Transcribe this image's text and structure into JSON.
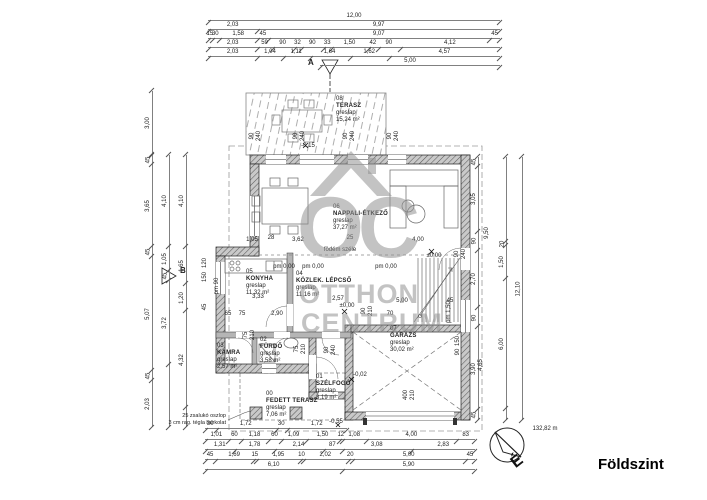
{
  "title": "Földszint",
  "watermark": {
    "letters": "OC",
    "line1": "OTTHON",
    "line2": "CENTRUM"
  },
  "compass": {
    "distance": "132,82 m",
    "north": "É"
  },
  "sections": {
    "a": "A",
    "b": "B"
  },
  "notes": {
    "l1": "25 zsalukó oszlop",
    "l2": "3 cm rag. tégla burkolat"
  },
  "annotations": {
    "slab_edge": "födém széle"
  },
  "rooms": {
    "r08": {
      "num": "08",
      "name": "TERASZ",
      "floor": "greslap",
      "area": "15,24 m²"
    },
    "r07": {
      "num": "07",
      "name": "GARÁZS",
      "floor": "greslap",
      "area": "30,02 m²"
    },
    "r06": {
      "num": "06",
      "name": "NAPPALI-ÉTKEZŐ",
      "floor": "greslap",
      "area": "37,27 m²"
    },
    "r05": {
      "num": "05",
      "name": "KONYHA",
      "floor": "greslap",
      "area": "11,32 m²"
    },
    "r04": {
      "num": "04",
      "name": "KÖZLEK. LÉPCSŐ",
      "floor": "greslap",
      "area": "11,16 m²"
    },
    "r03": {
      "num": "03",
      "name": "KAMRA",
      "floor": "greslap",
      "area": "2,57 m²"
    },
    "r02": {
      "num": "02",
      "name": "FÜRDŐ",
      "floor": "greslap",
      "area": "3,58 m²"
    },
    "r01": {
      "num": "01",
      "name": "SZÉLFOGÓ",
      "floor": "greslap",
      "area": "3,19 m²"
    },
    "r00": {
      "num": "00",
      "name": "FEDETT TERASZ",
      "floor": "greslap",
      "area": "7,06 m²"
    }
  },
  "chains": [
    {
      "d": "h",
      "x": 208,
      "y": 12,
      "len": 292,
      "segs": [
        {
          "t": "12,00",
          "w": 12
        }
      ]
    },
    {
      "d": "h",
      "x": 208,
      "y": 21,
      "len": 292,
      "segs": [
        {
          "t": "2,03",
          "w": 2.03
        },
        {
          "t": "9,97",
          "w": 9.97
        }
      ]
    },
    {
      "d": "h",
      "x": 208,
      "y": 30,
      "len": 292,
      "segs": [
        {
          "t": "15",
          "w": 0.15
        },
        {
          "t": "30",
          "w": 0.3
        },
        {
          "t": "1,58",
          "w": 1.58
        },
        {
          "t": "45",
          "w": 0.45
        },
        {
          "t": "9,07",
          "w": 9.07
        },
        {
          "t": "45",
          "w": 0.45
        }
      ]
    },
    {
      "d": "h",
      "x": 208,
      "y": 39,
      "len": 292,
      "segs": [
        {
          "t": "2,03",
          "w": 2.03
        },
        {
          "t": "59",
          "w": 0.59
        },
        {
          "t": "90",
          "w": 0.9
        },
        {
          "t": "32",
          "w": 0.32
        },
        {
          "t": "90",
          "w": 0.9
        },
        {
          "t": "33",
          "w": 0.33
        },
        {
          "t": "1,50",
          "w": 1.5
        },
        {
          "t": "42",
          "w": 0.42
        },
        {
          "t": "90",
          "w": 0.9
        },
        {
          "t": "4,12",
          "w": 4.12
        }
      ]
    },
    {
      "d": "h",
      "x": 208,
      "y": 48,
      "len": 292,
      "segs": [
        {
          "t": "2,03",
          "w": 2.03
        },
        {
          "t": "1,04",
          "w": 1.04
        },
        {
          "t": "1,11",
          "w": 1.11
        },
        {
          "t": "1,64",
          "w": 1.64
        },
        {
          "t": "1,62",
          "w": 1.62
        },
        {
          "t": "4,57",
          "w": 4.57
        }
      ]
    },
    {
      "d": "h",
      "x": 320,
      "y": 57,
      "len": 180,
      "segs": [
        {
          "t": "5,00",
          "w": 5
        }
      ]
    },
    {
      "d": "h",
      "x": 205,
      "y": 420,
      "len": 142,
      "segs": [
        {
          "t": "30",
          "w": 0.3
        },
        {
          "t": "1,72",
          "w": 1.72
        },
        {
          "t": "30",
          "w": 0.3
        },
        {
          "t": "1,72",
          "w": 1.72
        }
      ]
    },
    {
      "d": "h",
      "x": 205,
      "y": 431,
      "len": 270,
      "segs": [
        {
          "t": "1,01",
          "w": 1.01
        },
        {
          "t": "60",
          "w": 0.6
        },
        {
          "t": "1,18",
          "w": 1.18
        },
        {
          "t": "60",
          "w": 0.6
        },
        {
          "t": "1,09",
          "w": 1.09
        },
        {
          "t": "1,50",
          "w": 1.5
        },
        {
          "t": "12",
          "w": 0.12
        },
        {
          "t": "1,08",
          "w": 1.08
        },
        {
          "t": "4,00",
          "w": 4
        },
        {
          "t": "83",
          "w": 0.83
        }
      ]
    },
    {
      "d": "h",
      "x": 205,
      "y": 441,
      "len": 270,
      "segs": [
        {
          "t": "1,31",
          "w": 1.31
        },
        {
          "t": "1,78",
          "w": 1.78
        },
        {
          "t": "2,14",
          "w": 2.14
        },
        {
          "t": "87",
          "w": 0.87
        },
        {
          "t": "3,08",
          "w": 3.08
        },
        {
          "t": "2,83",
          "w": 2.83
        }
      ]
    },
    {
      "d": "h",
      "x": 205,
      "y": 451,
      "len": 270,
      "segs": [
        {
          "t": "45",
          "w": 0.45
        },
        {
          "t": "1,69",
          "w": 1.69
        },
        {
          "t": "15",
          "w": 0.15
        },
        {
          "t": "1,95",
          "w": 1.95
        },
        {
          "t": "10",
          "w": 0.1
        },
        {
          "t": "2,02",
          "w": 2.02
        },
        {
          "t": "20",
          "w": 0.2
        },
        {
          "t": "5,00",
          "w": 5
        },
        {
          "t": "45",
          "w": 0.45
        }
      ]
    },
    {
      "d": "h",
      "x": 205,
      "y": 461,
      "len": 270,
      "segs": [
        {
          "t": "6,10",
          "w": 6.1
        },
        {
          "t": "5,90",
          "w": 5.9
        }
      ]
    },
    {
      "d": "v",
      "x": 144,
      "y": 91,
      "len": 64,
      "segs": [
        {
          "t": "3,00",
          "w": 3
        }
      ]
    },
    {
      "d": "v",
      "x": 144,
      "y": 155,
      "len": 272,
      "segs": [
        {
          "t": "45",
          "w": 0.45
        },
        {
          "t": "3,65",
          "w": 3.65
        },
        {
          "t": "45",
          "w": 0.45
        },
        {
          "t": "5,07",
          "w": 5.07
        },
        {
          "t": "45",
          "w": 0.45
        },
        {
          "t": "2,03",
          "w": 2.03
        }
      ]
    },
    {
      "d": "v",
      "x": 161,
      "y": 155,
      "len": 272,
      "segs": [
        {
          "t": "4,10",
          "w": 4.1
        },
        {
          "t": "1,05",
          "w": 1.05
        },
        {
          "t": "45",
          "w": 0.45
        },
        {
          "t": "3,72",
          "w": 3.72
        },
        {
          "t": "",
          "w": 2.78
        }
      ]
    },
    {
      "d": "v",
      "x": 178,
      "y": 155,
      "len": 272,
      "segs": [
        {
          "t": "4,10",
          "w": 4.1
        },
        {
          "t": "1,65",
          "w": 1.65
        },
        {
          "t": "1,20",
          "w": 1.2
        },
        {
          "t": "4,32",
          "w": 4.32
        },
        {
          "t": "",
          "w": 0.83
        }
      ]
    },
    {
      "d": "v",
      "x": 470,
      "y": 157,
      "len": 263,
      "segs": [
        {
          "t": "45",
          "w": 0.45
        },
        {
          "t": "3,05",
          "w": 3.05
        },
        {
          "t": "90",
          "w": 0.9
        },
        {
          "t": "2,70",
          "w": 2.7
        },
        {
          "t": "90",
          "w": 0.9
        },
        {
          "t": "3,90",
          "w": 3.9
        },
        {
          "t": "45",
          "w": 0.45
        }
      ]
    },
    {
      "d": "v",
      "x": 498,
      "y": 157,
      "len": 263,
      "segs": [
        {
          "t": "",
          "w": 3.9
        },
        {
          "t": "20",
          "w": 0.2
        },
        {
          "t": "1,50",
          "w": 1.5
        },
        {
          "t": "6,00",
          "w": 6
        },
        {
          "t": "",
          "w": 0.5
        }
      ]
    },
    {
      "d": "v",
      "x": 514,
      "y": 157,
      "len": 263,
      "segs": [
        {
          "t": "12,10",
          "w": 12.1
        }
      ]
    }
  ],
  "labels": [
    {
      "t": "90",
      "x": 252,
      "y": 136,
      "r": 1
    },
    {
      "t": "240",
      "x": 259,
      "y": 136,
      "r": 1
    },
    {
      "t": "90",
      "x": 296,
      "y": 136,
      "r": 1
    },
    {
      "t": "240",
      "x": 303,
      "y": 136,
      "r": 1
    },
    {
      "t": "90",
      "x": 346,
      "y": 136,
      "r": 1
    },
    {
      "t": "240",
      "x": 353,
      "y": 136,
      "r": 1
    },
    {
      "t": "90",
      "x": 390,
      "y": 136,
      "r": 1
    },
    {
      "t": "240",
      "x": 397,
      "y": 136,
      "r": 1
    },
    {
      "t": "-0,15",
      "x": 308,
      "y": 146
    },
    {
      "t": "pm 0,00",
      "x": 284,
      "y": 267
    },
    {
      "t": "pm 0,00",
      "x": 313,
      "y": 267
    },
    {
      "t": "pm 0,00",
      "x": 386,
      "y": 267
    },
    {
      "t": "±0,00",
      "x": 434,
      "y": 256
    },
    {
      "t": "±0,00",
      "x": 347,
      "y": 306
    },
    {
      "t": "-0,02",
      "x": 360,
      "y": 375
    },
    {
      "t": "-0,55",
      "x": 336,
      "y": 422
    },
    {
      "t": "1,05",
      "x": 252,
      "y": 240
    },
    {
      "t": "28",
      "x": 271,
      "y": 238
    },
    {
      "t": "3,62",
      "x": 298,
      "y": 240
    },
    {
      "t": "25",
      "x": 350,
      "y": 238
    },
    {
      "t": "4,00",
      "x": 418,
      "y": 240
    },
    {
      "t": "3,33",
      "x": 258,
      "y": 297
    },
    {
      "t": "2,57",
      "x": 338,
      "y": 299
    },
    {
      "t": "65",
      "x": 228,
      "y": 314
    },
    {
      "t": "75",
      "x": 242,
      "y": 314
    },
    {
      "t": "2,90",
      "x": 277,
      "y": 314
    },
    {
      "t": "90",
      "x": 364,
      "y": 311,
      "r": 1
    },
    {
      "t": "210",
      "x": 371,
      "y": 311,
      "r": 1
    },
    {
      "t": "70",
      "x": 390,
      "y": 314
    },
    {
      "t": "5,00",
      "x": 402,
      "y": 301
    },
    {
      "t": "45",
      "x": 450,
      "y": 301
    },
    {
      "t": "400",
      "x": 406,
      "y": 395,
      "r": 1
    },
    {
      "t": "210",
      "x": 413,
      "y": 395,
      "r": 1
    },
    {
      "t": "75",
      "x": 246,
      "y": 335,
      "r": 1
    },
    {
      "t": "210",
      "x": 253,
      "y": 335,
      "r": 1
    },
    {
      "t": "75",
      "x": 297,
      "y": 349,
      "r": 1
    },
    {
      "t": "210",
      "x": 304,
      "y": 349,
      "r": 1
    },
    {
      "t": "90",
      "x": 327,
      "y": 350,
      "r": 1
    },
    {
      "t": "240",
      "x": 334,
      "y": 350,
      "r": 1
    },
    {
      "t": "120",
      "x": 205,
      "y": 263,
      "r": 1
    },
    {
      "t": "150",
      "x": 205,
      "y": 277,
      "r": 1
    },
    {
      "t": "pm 90",
      "x": 217,
      "y": 286,
      "r": 1
    },
    {
      "t": "45",
      "x": 205,
      "y": 307,
      "r": 1
    },
    {
      "t": "90",
      "x": 457,
      "y": 254,
      "r": 1
    },
    {
      "t": "240",
      "x": 464,
      "y": 254,
      "r": 1
    },
    {
      "t": "9,50",
      "x": 487,
      "y": 233,
      "r": 1
    },
    {
      "t": "4,65",
      "x": 481,
      "y": 365,
      "r": 1
    },
    {
      "t": "150",
      "x": 458,
      "y": 341,
      "r": 1
    },
    {
      "t": "90",
      "x": 458,
      "y": 352,
      "r": 1
    },
    {
      "t": "pm 1,50",
      "x": 449,
      "y": 312,
      "r": 1
    },
    {
      "t": "132,82 m",
      "x": 545,
      "y": 429
    }
  ]
}
